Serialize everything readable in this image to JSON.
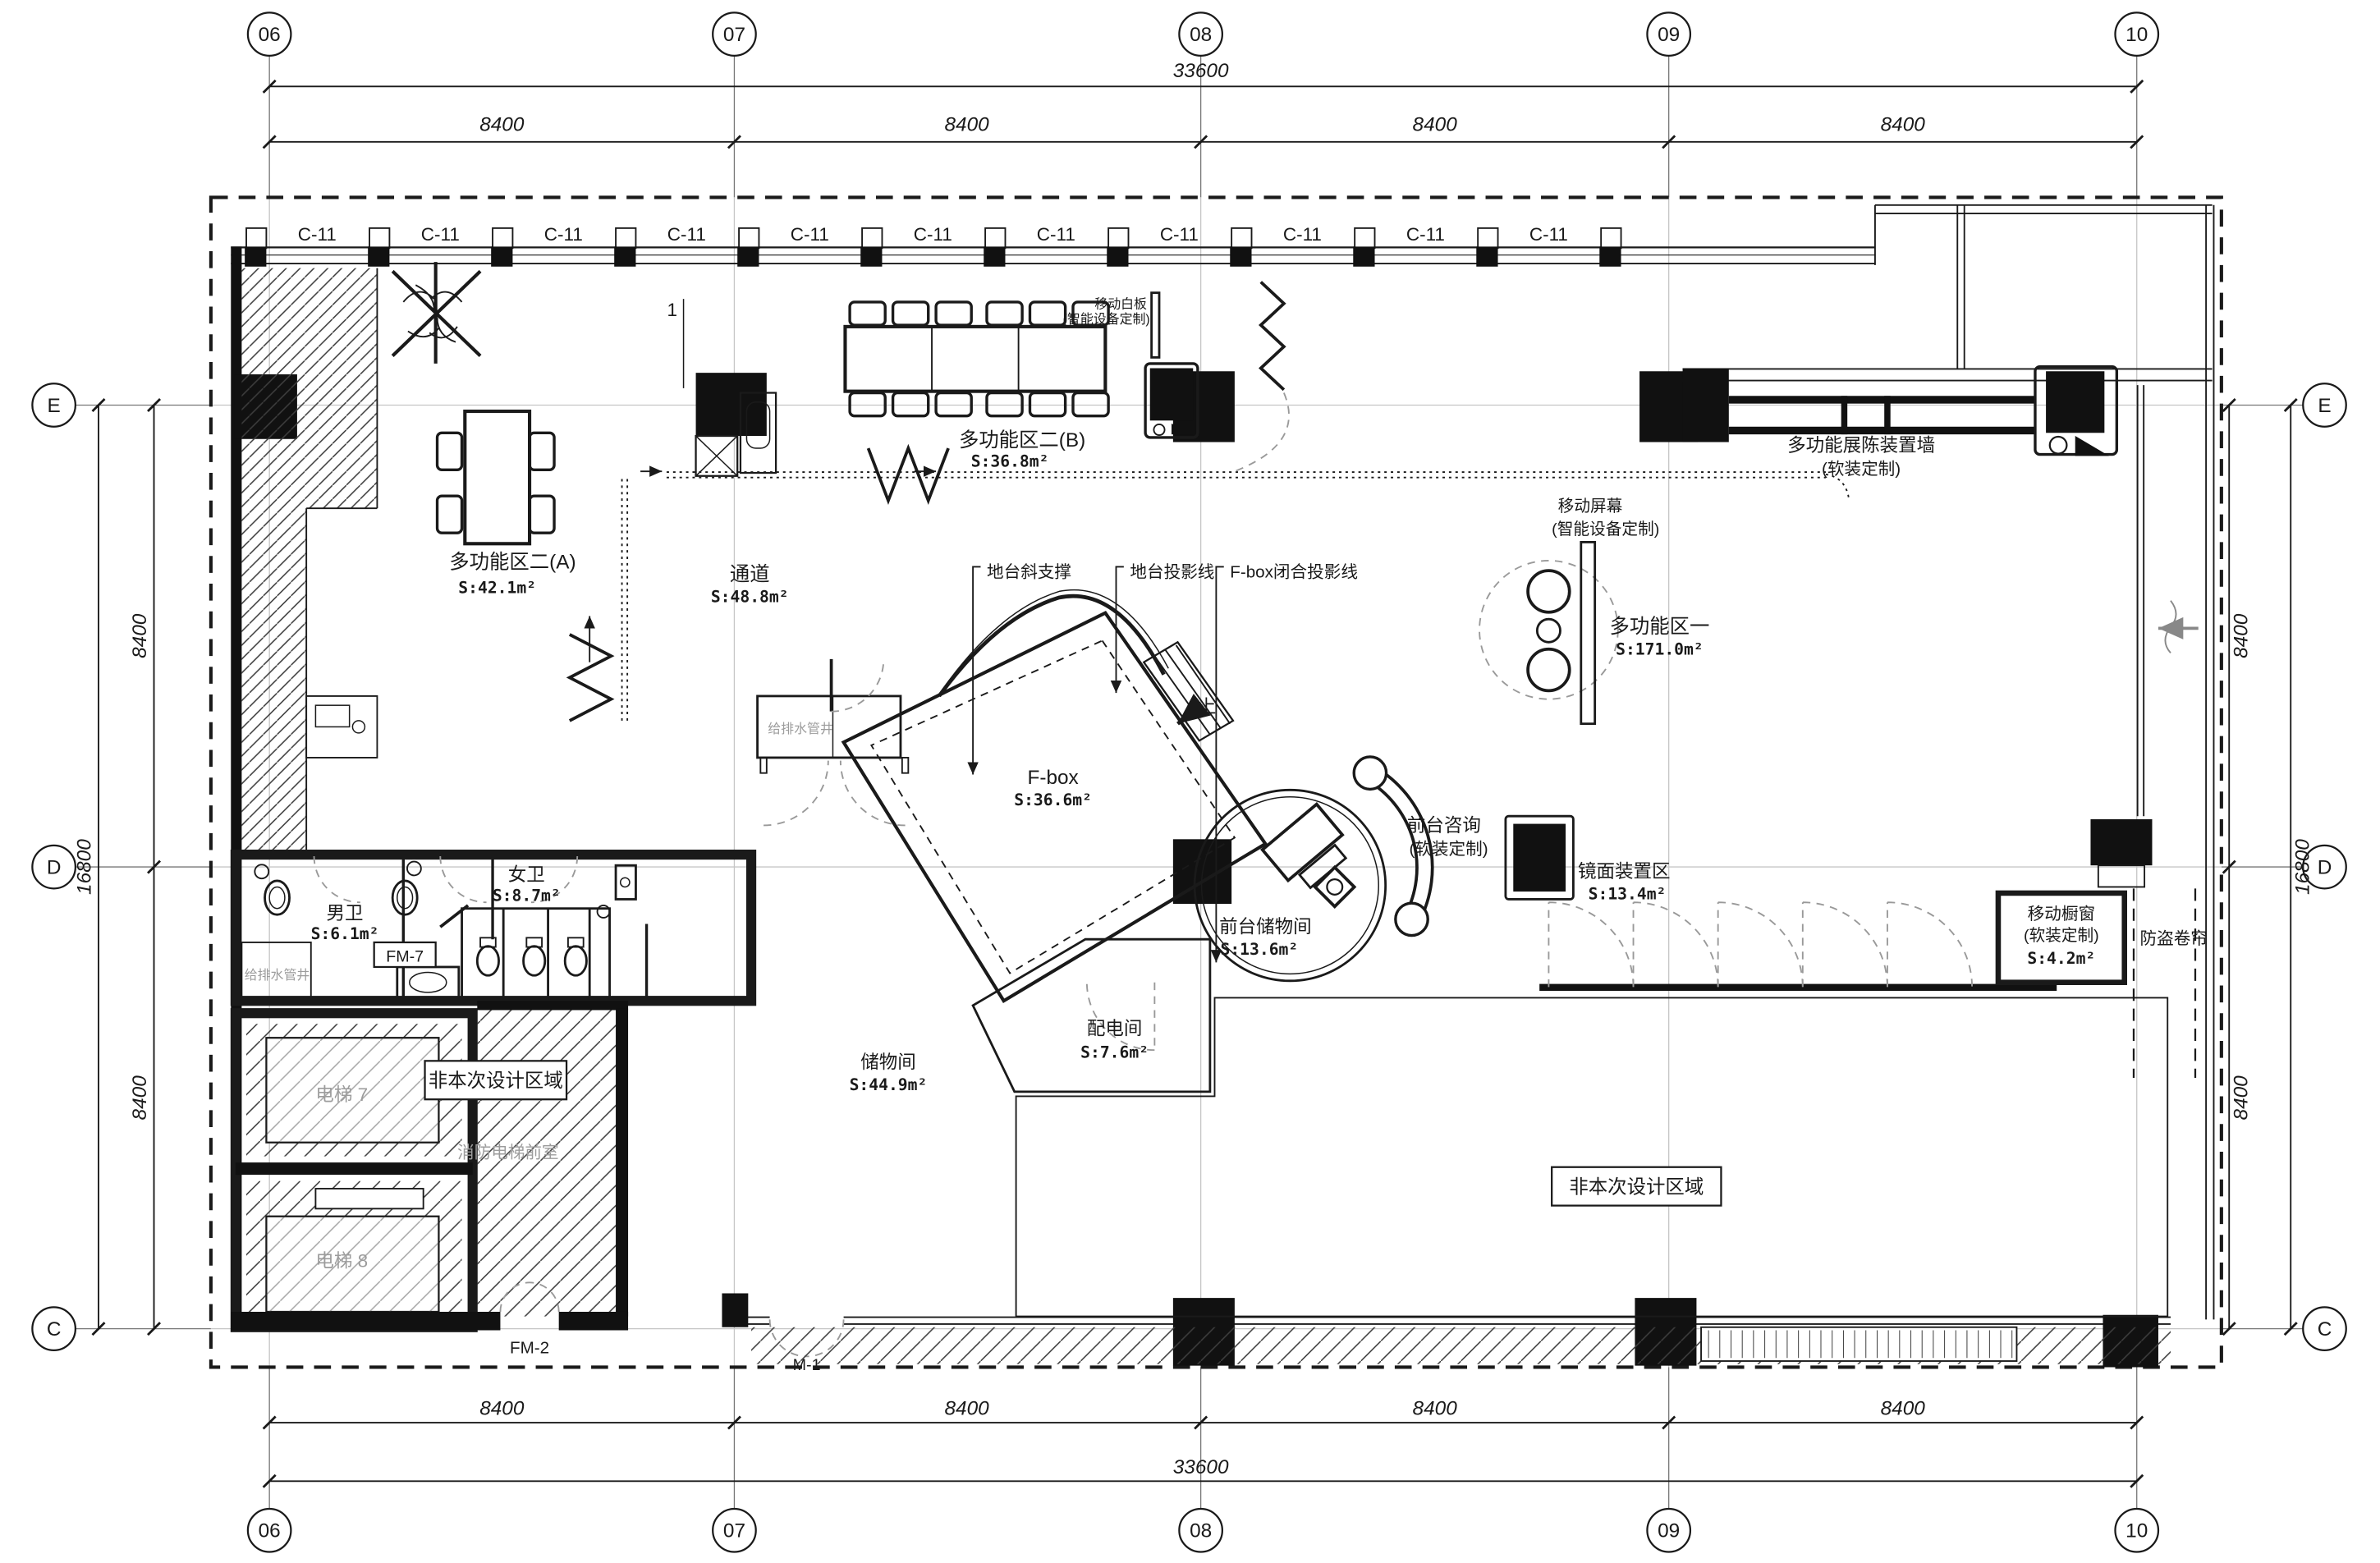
{
  "grid": {
    "cols": [
      "06",
      "07",
      "08",
      "09",
      "10"
    ],
    "rows": [
      "E",
      "D",
      "C"
    ],
    "span": "8400",
    "total_w": "33600",
    "total_h": "16800",
    "window": "C-11"
  },
  "rooms": {
    "mfa": {
      "name": "多功能区二(A)",
      "area": "S:42.1m²"
    },
    "mfb": {
      "name": "多功能区二(B)",
      "area": "S:36.8m²"
    },
    "corridor": {
      "name": "通道",
      "area": "S:48.8m²"
    },
    "fbox": {
      "name": "F-box",
      "area": "S:36.6m²"
    },
    "mf1": {
      "name": "多功能区一",
      "area": "S:171.0m²"
    },
    "reception_storage": {
      "name": "前台储物间",
      "area": "S:13.6m²"
    },
    "power": {
      "name": "配电间",
      "area": "S:7.6m²"
    },
    "storage": {
      "name": "储物间",
      "area": "S:44.9m²"
    },
    "female_wc": {
      "name": "女卫",
      "area": "S:8.7m²"
    },
    "male_wc": {
      "name": "男卫",
      "area": "S:6.1m²"
    },
    "mirror": {
      "name": "镜面装置区",
      "area": "S:13.4m²"
    },
    "showcase": {
      "name": "移动橱窗",
      "sub": "(软装定制)",
      "area": "S:4.2m²"
    }
  },
  "annotations": {
    "whiteboard": {
      "line1": "移动白板",
      "line2": "(智能设备定制)"
    },
    "screen": {
      "line1": "移动屏幕",
      "line2": "(智能设备定制)"
    },
    "display_wall": {
      "line1": "多功能展陈装置墙",
      "line2": "(软装定制)"
    },
    "reception": {
      "line1": "前台咨询",
      "line2": "(软装定制)"
    },
    "platform_support": "地台斜支撑",
    "platform_projection": "地台投影线",
    "fbox_projection": "F-box闭合投影线",
    "shutter": "防盗卷帘",
    "not_in_scope_a": "非本次设计区域",
    "not_in_scope_b": "非本次设计区域",
    "fire_lobby": "消防电梯前室",
    "elev7": "电梯 7",
    "elev8": "电梯 8",
    "shaft_left": "给排水管井",
    "shaft_mid": "给排水管井",
    "fm7": "FM-7",
    "fm2": "FM-2",
    "m1": "M-1",
    "up": "上",
    "detail": "1"
  }
}
